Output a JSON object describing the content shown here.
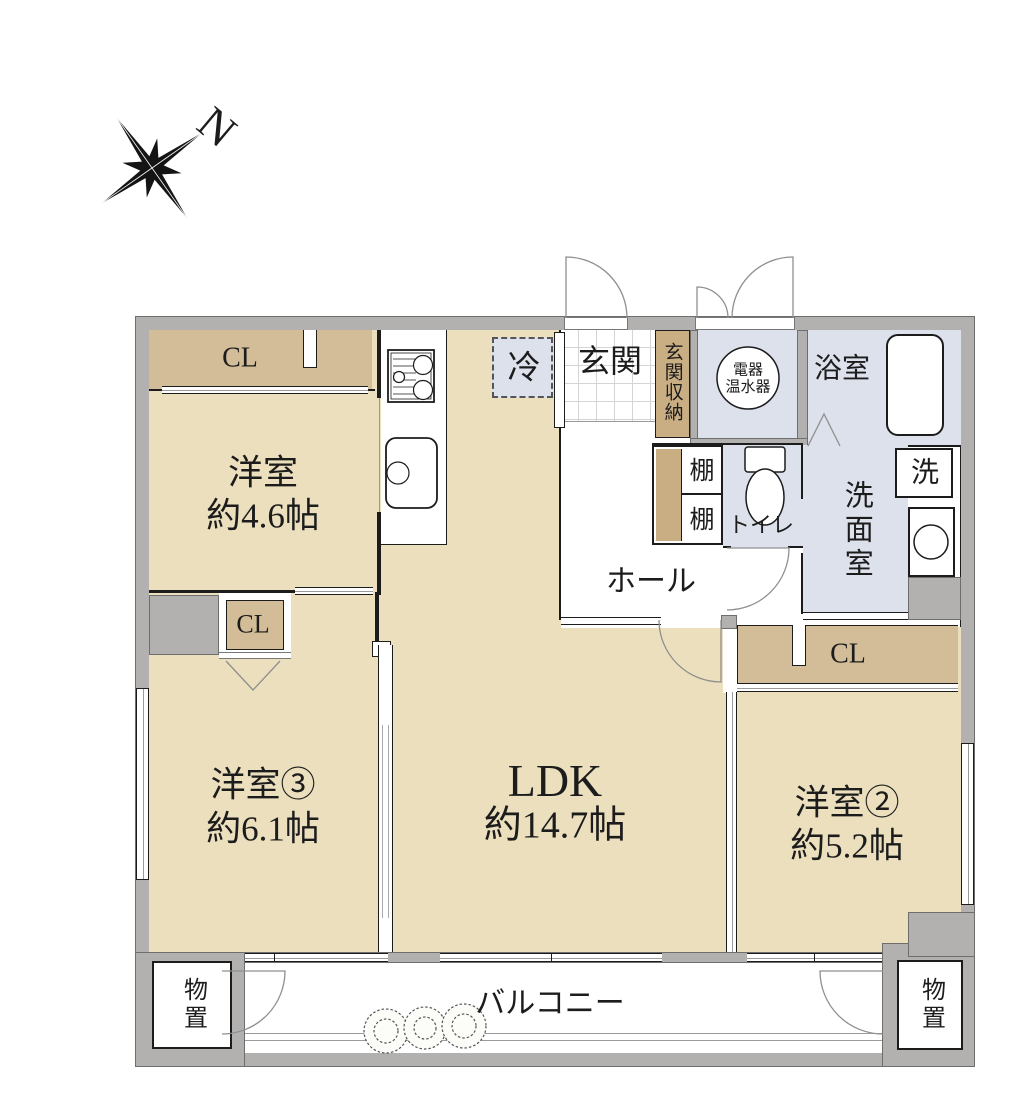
{
  "compass": {
    "north": "N"
  },
  "colors": {
    "room_floor": "#ebdfbd",
    "closet": "#d3bd98",
    "storage_strip": "#c9ad83",
    "wet_area": "#dde1ec",
    "wall": "#b2b1af",
    "line": "#1c1c1c"
  },
  "rooms": {
    "bedroom1": {
      "name": "洋室",
      "size": "約4.6帖"
    },
    "bedroom3": {
      "name": "洋室③",
      "size": "約6.1帖"
    },
    "bedroom2": {
      "name": "洋室②",
      "size": "約5.2帖"
    },
    "ldk": {
      "name": "LDK",
      "size": "約14.7帖"
    },
    "hall": {
      "name": "ホール"
    },
    "entrance": {
      "name": "玄関"
    },
    "entrance_storage": {
      "name": "玄関収納"
    },
    "water_heater": {
      "line1": "電器",
      "line2": "温水器"
    },
    "bathroom": {
      "name": "浴室"
    },
    "washroom": {
      "name": "洗面室"
    },
    "washer": {
      "name": "洗"
    },
    "toilet": {
      "name": "トイレ"
    },
    "shelf_upper": {
      "name": "棚"
    },
    "shelf_lower": {
      "name": "棚"
    },
    "refrigerator": {
      "name": "冷"
    },
    "closet_top_left": {
      "name": "CL"
    },
    "closet_mid_left": {
      "name": "CL"
    },
    "closet_right": {
      "name": "CL"
    },
    "storage_left": {
      "name": "物置"
    },
    "storage_right": {
      "name": "物置"
    },
    "balcony": {
      "name": "バルコニー"
    }
  }
}
